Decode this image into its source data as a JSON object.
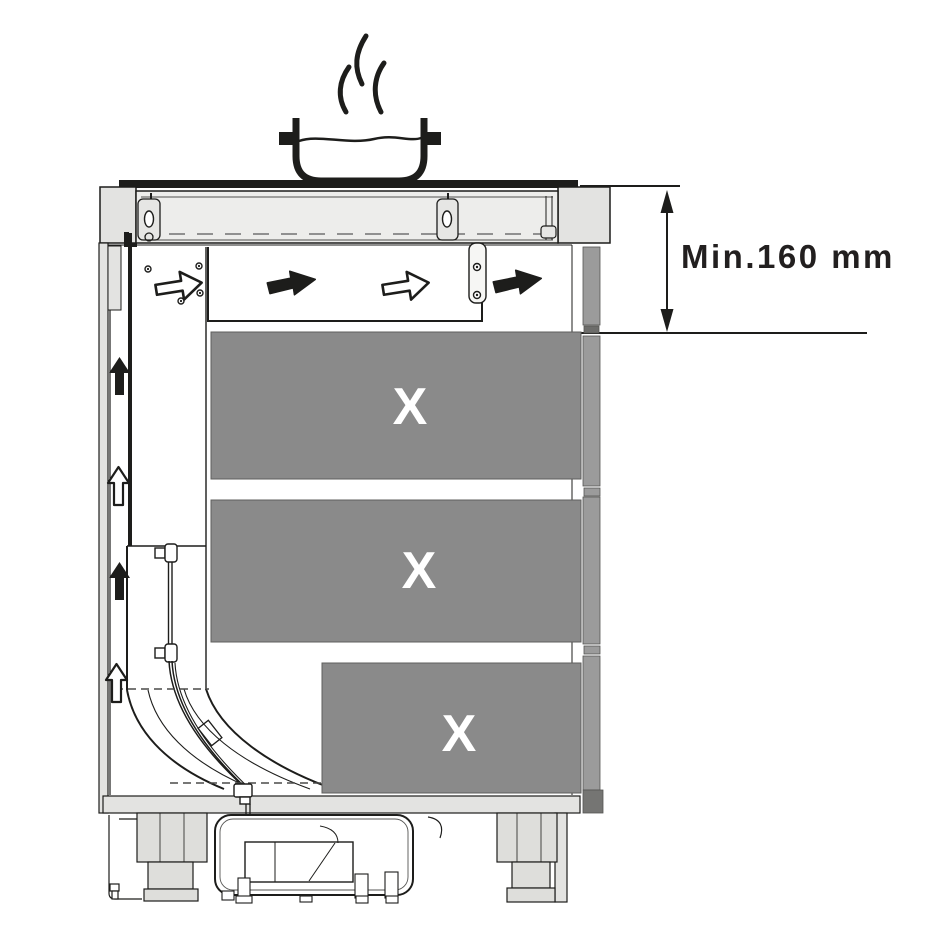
{
  "diagram": {
    "type": "appliance-installation-cross-section",
    "dimension": {
      "label": "Min.160 mm"
    },
    "drawers": [
      {
        "label": "X"
      },
      {
        "label": "X"
      },
      {
        "label": "X"
      }
    ],
    "colors": {
      "line": "#1d1d1b",
      "panel_light": "#e3e3e1",
      "hob_fill": "#ededeb",
      "drawer_gray": "#8a8a8a",
      "front_strip_gray": "#9b9b9b",
      "dark_accent": "#757575",
      "label_white": "#ffffff",
      "text_dark": "#221f1f"
    },
    "icons": {
      "steam": "〜",
      "pot": "▭",
      "airflow_right_solid": "▶",
      "airflow_right_outline": "▷",
      "airflow_up_solid": "▲",
      "airflow_up_outline": "△"
    }
  }
}
